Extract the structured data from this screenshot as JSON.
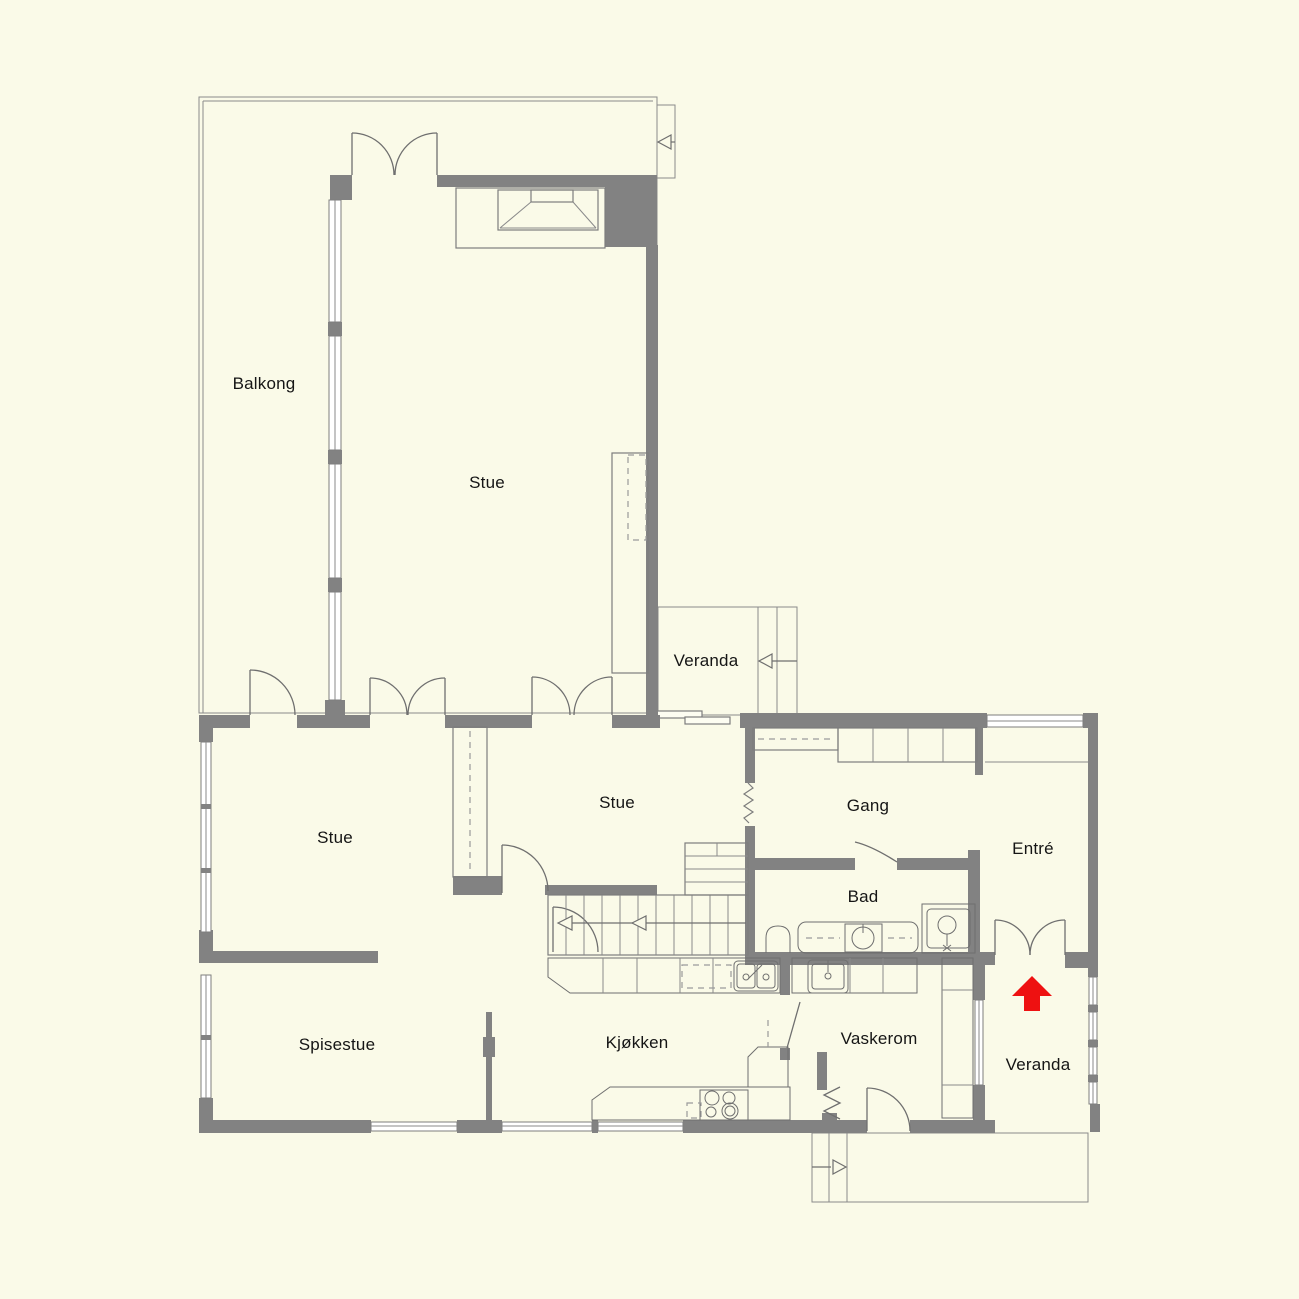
{
  "plan": {
    "type": "residential-floor-plan",
    "language": "Norwegian"
  },
  "rooms": [
    {
      "id": "balkong",
      "label": "Balkong"
    },
    {
      "id": "stue-upper",
      "label": "Stue"
    },
    {
      "id": "veranda-upper",
      "label": "Veranda"
    },
    {
      "id": "stue-middle",
      "label": "Stue"
    },
    {
      "id": "stue-left",
      "label": "Stue"
    },
    {
      "id": "gang",
      "label": "Gang"
    },
    {
      "id": "entre",
      "label": "Entré"
    },
    {
      "id": "bad",
      "label": "Bad"
    },
    {
      "id": "spisestue",
      "label": "Spisestue"
    },
    {
      "id": "kjokken",
      "label": "Kjøkken"
    },
    {
      "id": "vaskerom",
      "label": "Vaskerom"
    },
    {
      "id": "veranda-lower",
      "label": "Veranda"
    }
  ],
  "icons": {
    "entrance_arrow": "red-up-arrow",
    "stair_direction_arrows": "open-triangle-arrows",
    "fireplace": "trapezoid-hearth-symbol",
    "shower": "square-cabin-with-head",
    "wc": "rounded-toilet-symbol",
    "sinks": "basin-with-faucet"
  },
  "colors": {
    "background": "#fafae8",
    "wall": "#828282",
    "outline": "#7d7d7d",
    "entrance_arrow": "#ee1111",
    "text": "#151515"
  }
}
